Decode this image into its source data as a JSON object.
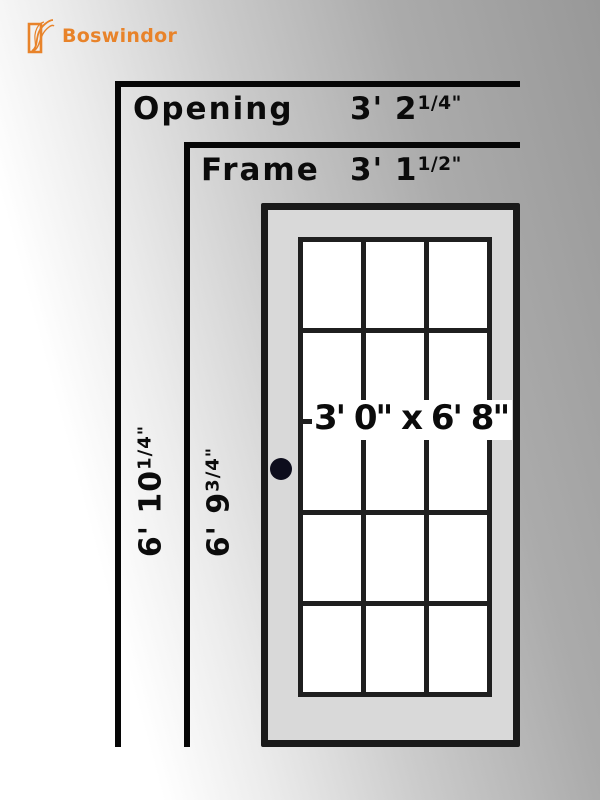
{
  "brand": {
    "name": "Boswindor",
    "icon": "door-flourish-icon",
    "accent_color": "#e8832a"
  },
  "colors": {
    "line_black": "#060606",
    "door_border": "#1a1a1a",
    "door_fill": "#d9d9d9",
    "muntin": "#1f1f1f",
    "glass": "#ffffff",
    "knob": "#0d0d1c",
    "background_from": "#ffffff",
    "background_to": "#989898"
  },
  "annotations": {
    "opening": {
      "label": "Opening",
      "value_main": "3' 2",
      "value_sup": "1/4\""
    },
    "frame": {
      "label": "Frame",
      "value_main": "3' 1",
      "value_sup": "1/2\""
    },
    "opening_height": {
      "value_main": "6' 10",
      "value_sup": "1/4\""
    },
    "frame_height": {
      "value_main": "6' 9",
      "value_sup": "3/4\""
    }
  },
  "door": {
    "size_label": "3' 0\" x 6' 8\"",
    "lite_grid": {
      "columns": 3,
      "rows": 5
    }
  }
}
